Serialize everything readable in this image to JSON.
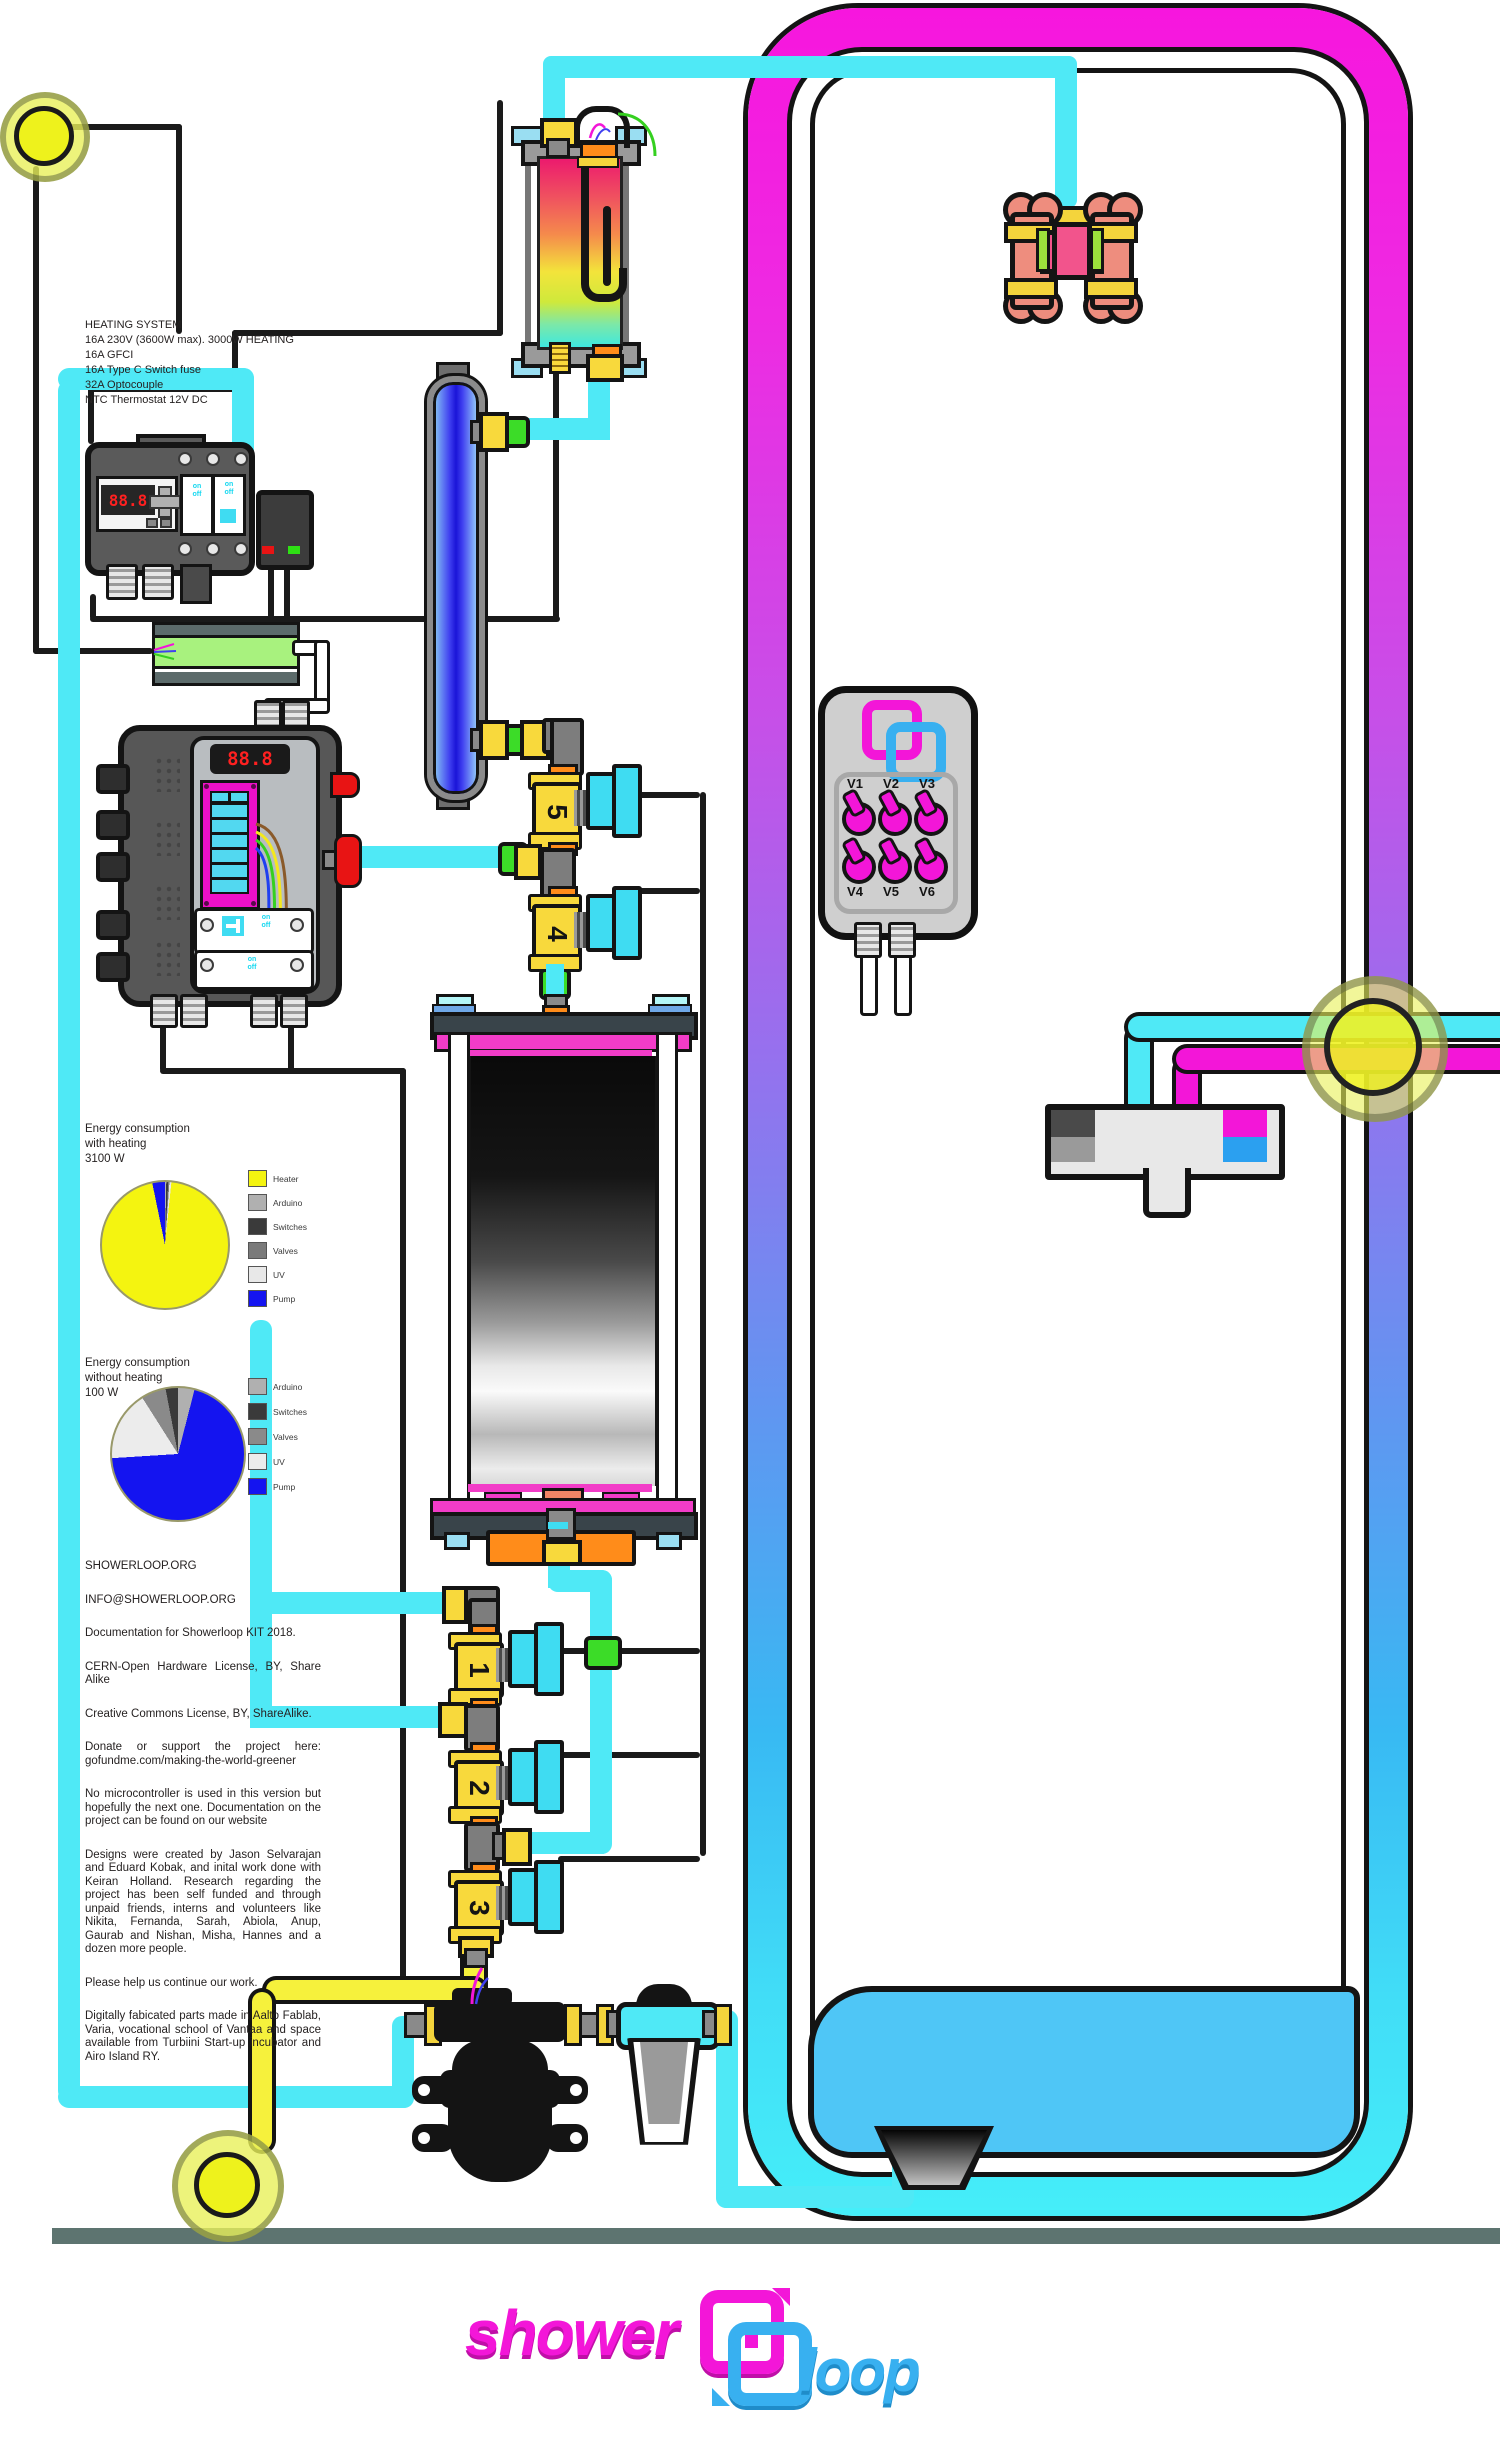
{
  "heating": {
    "lines": [
      "HEATING SYSTEM",
      "16A 230V (3600W max). 3000W HEATING",
      "16A GFCI",
      "16A Type C Switch fuse",
      "32A Optocouple",
      "NTC Thermostat 12V DC"
    ]
  },
  "chart_data": [
    {
      "type": "pie",
      "title_lines": [
        "Energy consumption",
        "with heating",
        "3100 W"
      ],
      "total_watts": 3100,
      "slices": [
        {
          "label": "Arduino",
          "value": 10,
          "color": "#b0b0b0"
        },
        {
          "label": "Switches",
          "value": 15,
          "color": "#3a3a3a"
        },
        {
          "label": "Valves",
          "value": 10,
          "color": "#7a7a7a"
        },
        {
          "label": "UV",
          "value": 15,
          "color": "#e8e8e8"
        },
        {
          "label": "Heater",
          "value": 2950,
          "color": "#f4f410"
        },
        {
          "label": "Pump",
          "value": 100,
          "color": "#1414f0"
        }
      ],
      "legend": [
        {
          "label": "Heater",
          "color": "#f4f410"
        },
        {
          "label": "Arduino",
          "color": "#b0b0b0"
        },
        {
          "label": "Switches",
          "color": "#3a3a3a"
        },
        {
          "label": "Valves",
          "color": "#7a7a7a"
        },
        {
          "label": "UV",
          "color": "#e8e8e8"
        },
        {
          "label": "Pump",
          "color": "#1414f0"
        }
      ]
    },
    {
      "type": "pie",
      "title_lines": [
        "Energy consumption",
        "without heating",
        "100 W"
      ],
      "total_watts": 100,
      "slices": [
        {
          "label": "Arduino",
          "value": 4,
          "color": "#b0b0b0"
        },
        {
          "label": "Pump",
          "value": 70,
          "color": "#1414f0"
        },
        {
          "label": "UV",
          "value": 17,
          "color": "#ececec"
        },
        {
          "label": "Valves",
          "value": 6,
          "color": "#8a8a8a"
        },
        {
          "label": "Switches",
          "value": 3,
          "color": "#3a3a3a"
        }
      ],
      "legend": [
        {
          "label": "Arduino",
          "color": "#b0b0b0"
        },
        {
          "label": "Switches",
          "color": "#3a3a3a"
        },
        {
          "label": "Valves",
          "color": "#8a8a8a"
        },
        {
          "label": "UV",
          "color": "#ececec"
        },
        {
          "label": "Pump",
          "color": "#1414f0"
        }
      ]
    }
  ],
  "info": {
    "paragraphs": [
      "SHOWERLOOP.ORG",
      "INFO@SHOWERLOOP.ORG",
      "Documentation for Showerloop KIT 2018.",
      "CERN-Open Hardware License, BY, Share Alike",
      "Creative Commons License, BY, ShareAlike.",
      "Donate or support the project here: gofundme.com/making-the-world-greener",
      "No microcontroller is used in this version but hopefully the next one. Documentation on the project can be found on our website",
      "Designs were created by Jason Selvarajan and Eduard Kobak, and inital work done with Keiran Holland. Research regarding the project has been self funded and through unpaid friends, interns and volunteers like Nikita, Fernanda, Sarah, Abiola, Anup, Gaurab and Nishan, Misha, Hannes and a dozen more people.",
      "Please help us continue our work.",
      "Digitally fabicated parts made in Aalto Fablab, Varia, vocational school of Vantaa and space available from Turbiini Start-up incubator and Airo Island RY."
    ]
  },
  "valve_box": {
    "top": [
      "V1",
      "V2",
      "V3"
    ],
    "bottom": [
      "V4",
      "V5",
      "V6"
    ]
  },
  "valves": {
    "v1": "1",
    "v2": "2",
    "v3": "3",
    "v4": "4",
    "v5": "5"
  },
  "controllers": {
    "display": "88.8",
    "on": "on",
    "off": "off"
  },
  "logo": {
    "word1": "shower",
    "word2": "loop"
  },
  "colors": {
    "magenta": "#f316d8",
    "cyan_pipe": "#4fe9f6",
    "blue_water": "#4fc6f6",
    "yellow_pipe": "#f6f13c",
    "valve_yellow": "#f8d93c",
    "orange": "#ff8c1a",
    "green_connector": "#3cdc28",
    "enclosure_top": "#f716de",
    "enclosure_bottom": "#45eef9",
    "floor": "#5d7470"
  }
}
